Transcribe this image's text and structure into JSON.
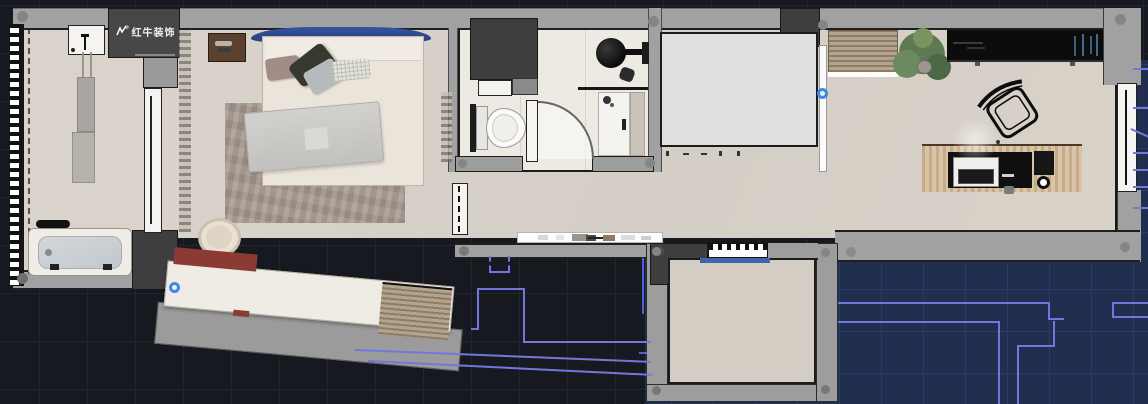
{
  "watermark": {
    "text": "红牛装饰",
    "registered": "®",
    "icon": "bull-logo-icon"
  },
  "colors": {
    "background_dark": "#16191f",
    "grid_dark": "#21262e",
    "background_navy": "#212e4f",
    "grid_navy": "#2c3b62",
    "cad_line_purple": "#7277dd",
    "cad_line_blue": "#4e62d8",
    "grip_blue": "#3f87e8",
    "wall_gray": "#a1a1a1",
    "dark_block": "#3e3e3e",
    "floor_beige": "#d8d2ca",
    "floor_bath_white": "#edeae3",
    "headboard_blue": "#2c4c99",
    "wardrobe_maroon": "#8c3a34",
    "desk_wood": "#d6bd9c",
    "cabinet_wood": "#a9977f",
    "counter_black": "#0c0c0c",
    "plant_green": "#5d7a52",
    "balcony_sill_blue": "#3f66a8",
    "rug_taupe": "#a89b92"
  },
  "rooms": {
    "laundry_bathroom": [
      "sink-counter",
      "faucet",
      "water-heater",
      "bathtub"
    ],
    "bedroom": [
      "double-bed",
      "headboard",
      "pillows",
      "blanket",
      "area-rug",
      "nightstand-left",
      "nightstand-right",
      "stool",
      "curtain",
      "angled-wardrobe"
    ],
    "bathroom": [
      "vanity-block",
      "toilet",
      "round-basin",
      "glass-partition",
      "shower-tray",
      "swing-door"
    ],
    "living_office": [
      "storage-volume",
      "wood-cabinet",
      "potted-plant",
      "black-counter",
      "desk",
      "office-chair",
      "monitor",
      "cup",
      "wall-shelf",
      "side-window"
    ],
    "balcony": [
      "hatched-window",
      "sill-line"
    ]
  },
  "grips": [
    "wardrobe-left-end-grip",
    "storage-right-edge-grip"
  ]
}
